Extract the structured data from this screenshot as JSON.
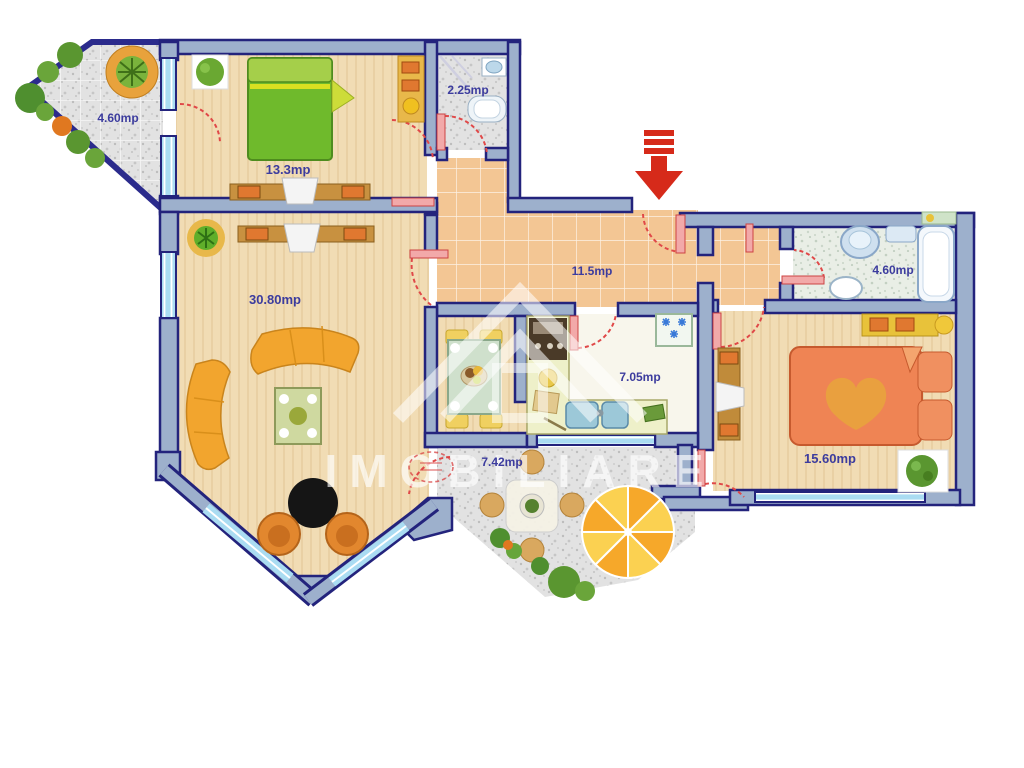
{
  "title": "Apartment floor plan",
  "watermark": {
    "text": "IMOBILIARE"
  },
  "rooms": {
    "balcony": {
      "name": "balcony-top-left",
      "area": "4.60mp"
    },
    "bedroom_small": {
      "name": "bedroom-small",
      "area": "13.3mp"
    },
    "wc": {
      "name": "wc",
      "area": "2.25mp"
    },
    "hallway": {
      "name": "hallway",
      "area": "11.5mp"
    },
    "living": {
      "name": "living-room",
      "area": "30.80mp"
    },
    "kitchen": {
      "name": "kitchen",
      "area": "7.05mp"
    },
    "bathroom": {
      "name": "bathroom",
      "area": "4.60mp"
    },
    "bedroom_large": {
      "name": "bedroom-large",
      "area": "15.60mp"
    },
    "terrace": {
      "name": "terrace-bottom",
      "area": "7.42mp"
    }
  },
  "colors": {
    "wall_fill": "#9db0cc",
    "wall_outline": "#23237c",
    "door_arc": "#e04848",
    "door_leaf": "#f2a9a9",
    "entrance_arrow": "#d62a1a",
    "window_glass": "#aadcf2",
    "floor_beige": "#f1dcb4",
    "floor_tile": "#f3c694",
    "floor_stone": "#e2e2e2"
  }
}
